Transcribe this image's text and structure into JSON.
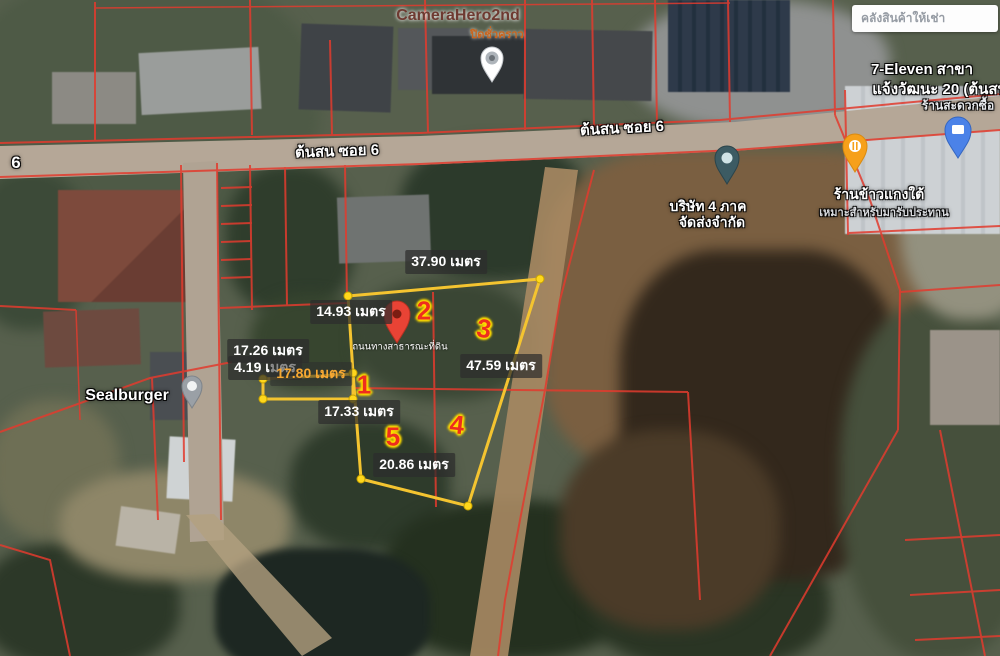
{
  "street": {
    "soi_label_left": "ต้นสน ซอย 6",
    "soi_label_right": "ต้นสน ซอย 6",
    "edge_number": "6"
  },
  "places": {
    "camera_hero": {
      "name": "CameraHero2nd",
      "status": "ปิดชั่วคราว"
    },
    "sealburger": {
      "name": "Sealburger"
    },
    "company": {
      "line1": "บริษัท 4 ภาค",
      "line2": "จัดส่งจำกัด"
    },
    "seven_eleven": {
      "line1": "7-Eleven สาขา",
      "line2": "แจ้งวัฒนะ 20 (ต้นสน",
      "line3": "ร้านสะดวกซื้อ"
    },
    "curry_shop": {
      "name": "ร้านข้าวแกงใต้",
      "subtitle": "เหมาะสำหรับมารับประทาน"
    },
    "warehouse_ad": {
      "text": "คลังสินค้าให้เช่า"
    }
  },
  "parcel": {
    "access_note": "ถนนทางสาธารณะที่ดิน",
    "measurements": {
      "top": "37.90 เมตร",
      "upper_left": "14.93 เมตร",
      "left_a": "17.26 เมตร",
      "left_b": "4.19 เมตร",
      "strip": "17.80 เมตร",
      "right": "47.59 เมตร",
      "middle": "17.33 เมตร",
      "bottom": "20.86 เมตร"
    },
    "plot_numbers": {
      "p1": "1",
      "p2": "2",
      "p3": "3",
      "p4": "4",
      "p5": "5"
    }
  },
  "colors": {
    "parcel_line": "#e23b2e",
    "plot_outline": "#f4c430",
    "marker_text": "#ee2d1e",
    "pin_red": "#e94335"
  }
}
